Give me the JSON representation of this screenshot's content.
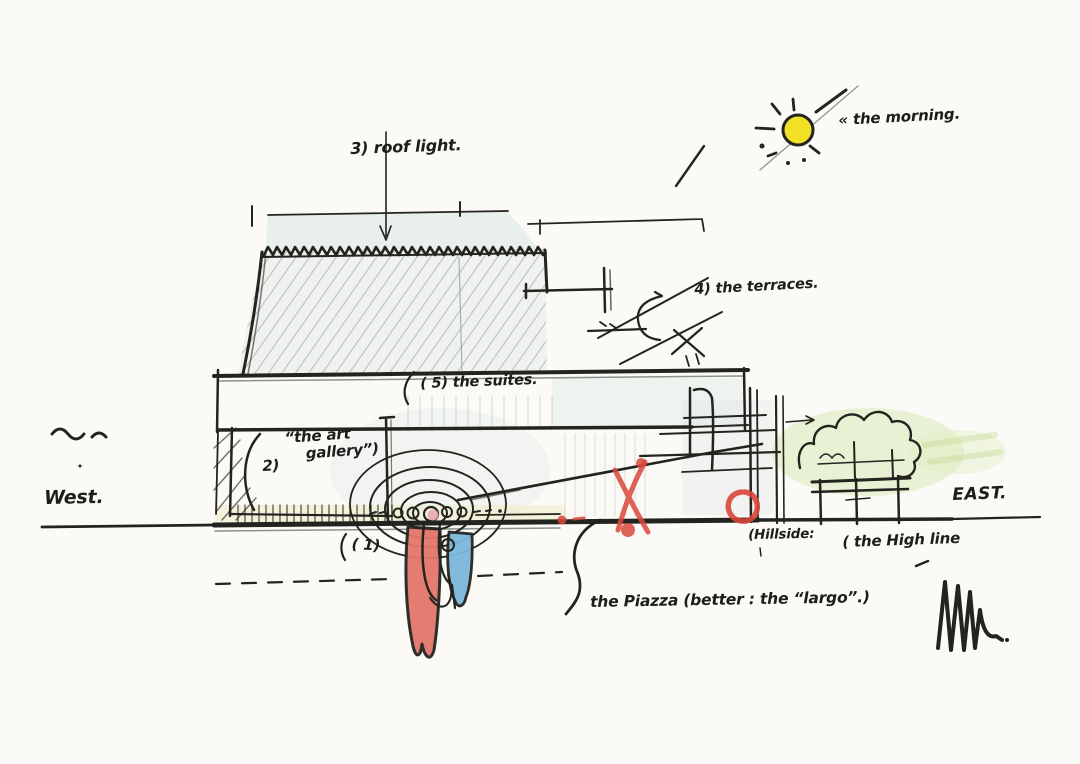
{
  "title": "Architectural concept section sketch (West–East) with handwritten notes",
  "colors": {
    "paper": "#fbfaf6",
    "ink": "#23241f",
    "pencil": "#8d9596",
    "wash_blue": "#d8e5e4",
    "wash_yellow": "#f0e9c0",
    "sun_yellow": "#f0e126",
    "accent_red": "#d8463a",
    "fill_red": "#e4766b",
    "fill_blue": "#7cb7da",
    "foliage_green": "#dcebbc"
  },
  "labels": {
    "sun_note": "« the morning.",
    "roof_light": "3) roof light.",
    "terraces": "4) the terraces.",
    "suites": "( 5) the suites.",
    "art_gallery_no": "2)",
    "art_gallery": "“the art\n    gallery”)",
    "entrance_no": "( 1)",
    "piazza": "the Piazza (better : the “largo”.)",
    "hillside": "(Hillside:",
    "high_line": "( the High line",
    "west": "West.",
    "east": "EAST."
  }
}
